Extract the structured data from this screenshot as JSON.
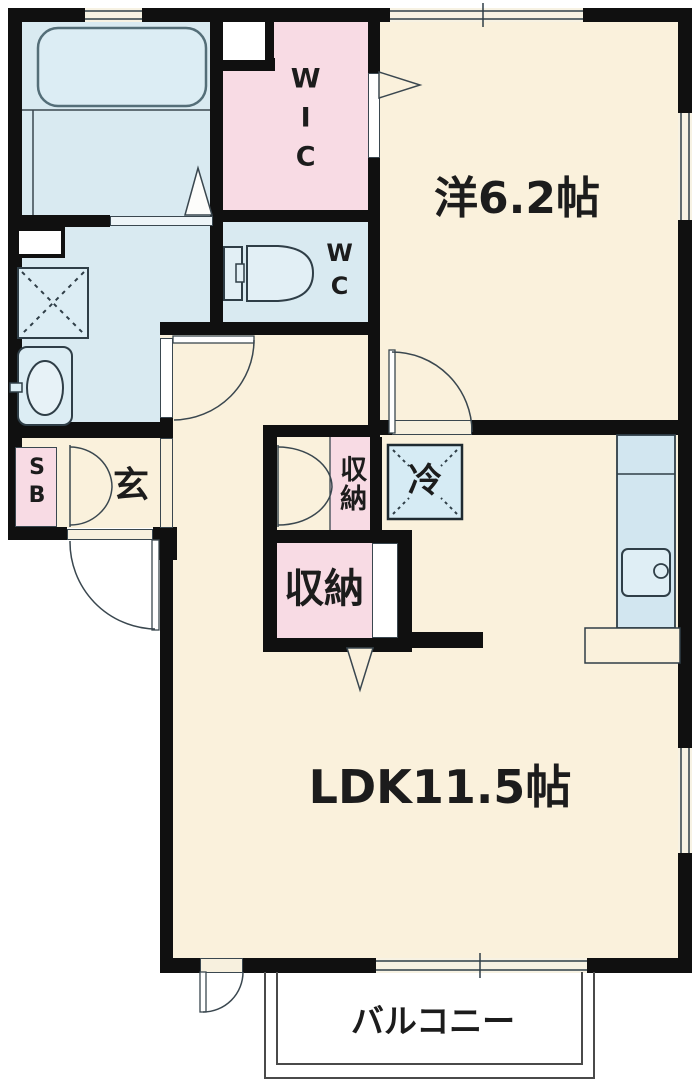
{
  "floorplan": {
    "title": "1LDK apartment floor plan",
    "rooms": {
      "bedroom_label": "洋6.2帖",
      "ldk_label": "LDK11.5帖",
      "balcony_label": "バルコニー",
      "wic_label": "WIC",
      "wc_label": "WC",
      "entrance_label": "玄",
      "hall_closet_label": "収納",
      "ldk_closet_label": "収納",
      "refrigerator_label": "冷",
      "shoe_box_label": "SB"
    },
    "colors": {
      "wall": "#101010",
      "room_cream": "#FAF1DC",
      "room_pink": "#F8DBE4",
      "room_blue": "#D9EAF1",
      "kitchen_counter_blue": "#D2E6F0",
      "fixture_outline": "#2F3E47",
      "balcony_line": "#4A4A4A",
      "text": "#1C1C1C"
    }
  }
}
